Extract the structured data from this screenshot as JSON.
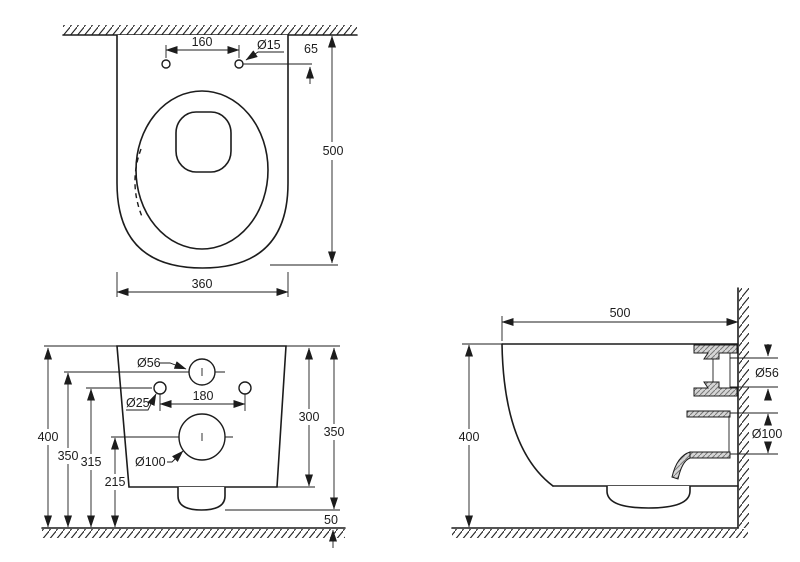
{
  "drawing": {
    "colors": {
      "line": "#1c1c1c",
      "background": "#ffffff",
      "hatch_fill": "#d6d6d6"
    },
    "top_view": {
      "dim_hole_spacing": "160",
      "dim_hole_diameter": "Ø15",
      "dim_wall_to_holes": "65",
      "dim_depth": "500",
      "dim_width": "360"
    },
    "rear_view": {
      "dim_inlet_diameter": "Ø56",
      "dim_fixing_hole_diameter": "Ø25",
      "dim_fixing_spacing": "180",
      "dim_outlet_diameter": "Ø100",
      "dim_total_height": "400",
      "dim_inlet_height": "350",
      "dim_fixing_height": "315",
      "dim_outlet_height": "215",
      "dim_body_height": "300",
      "dim_body_to_lowest": "350",
      "dim_floor_clearance": "50"
    },
    "side_view": {
      "dim_depth": "500",
      "dim_height": "400",
      "dim_inlet_diameter": "Ø56",
      "dim_outlet_diameter": "Ø100"
    }
  }
}
